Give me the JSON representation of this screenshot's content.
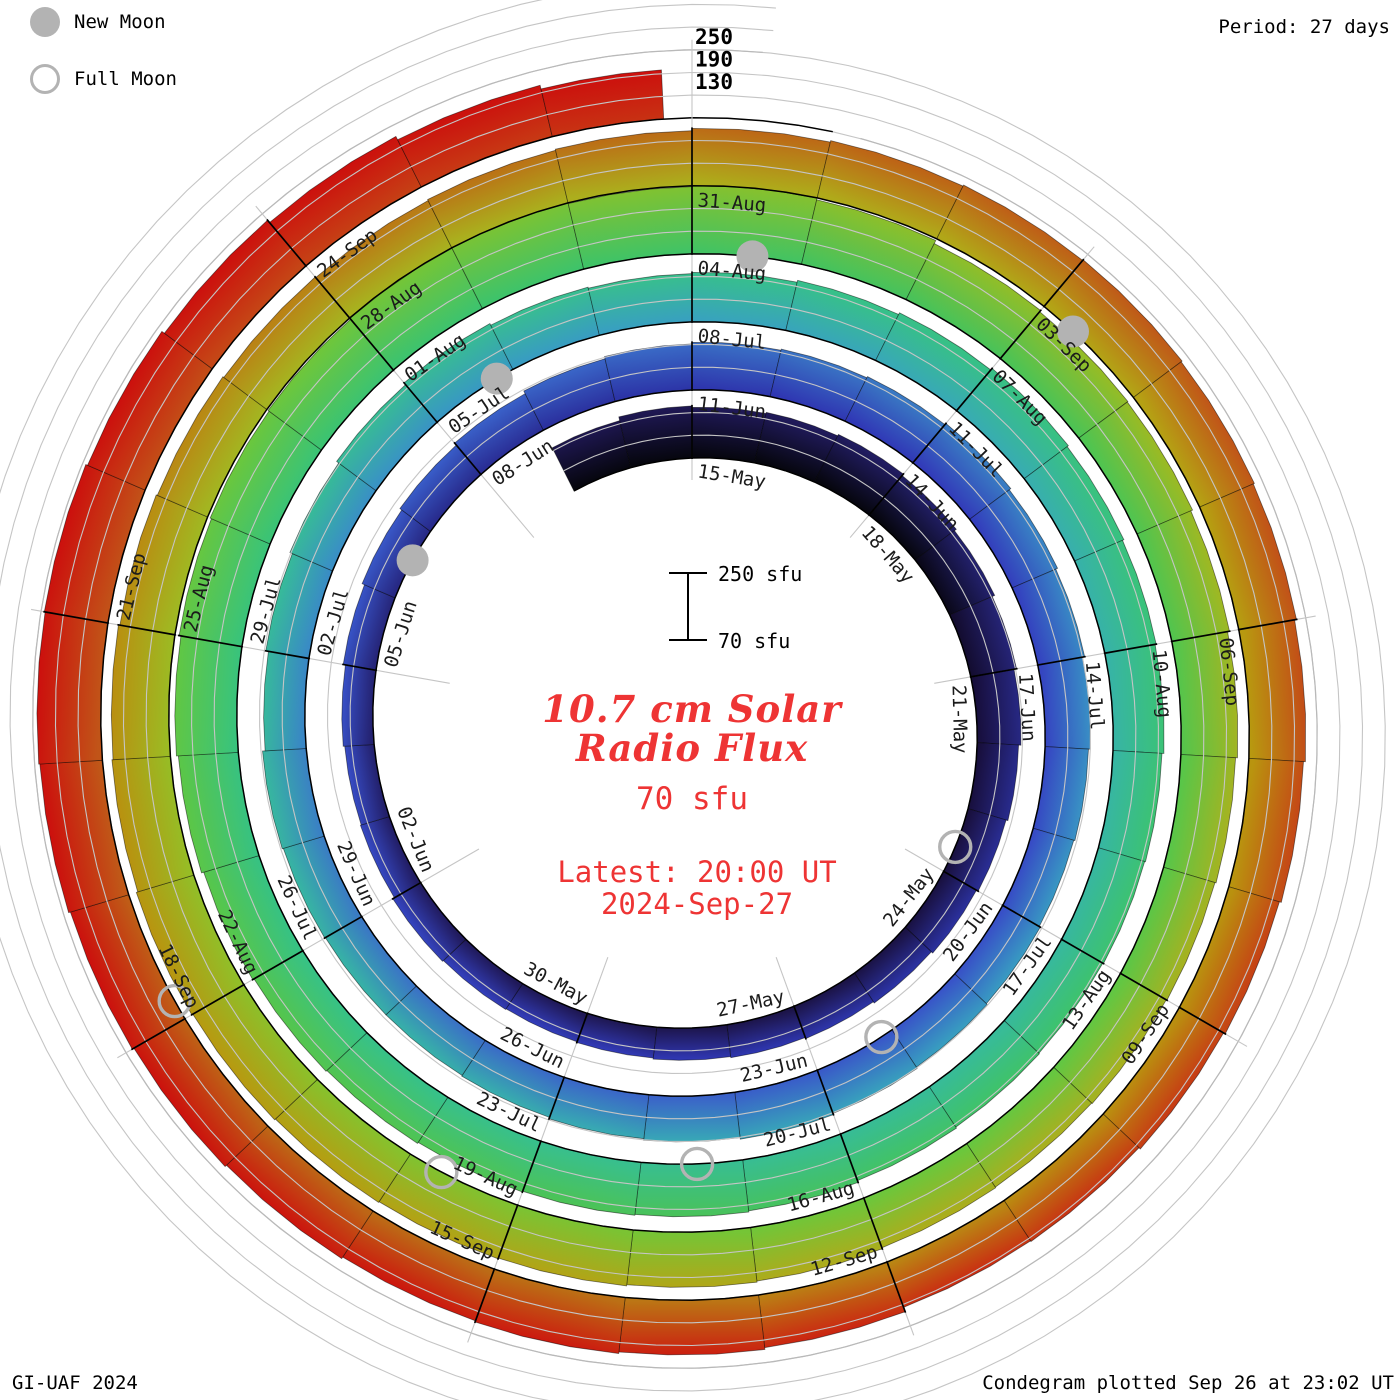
{
  "legend": {
    "new_moon_label": "New Moon",
    "full_moon_label": "Full Moon",
    "moon_color": "#b3b3b3"
  },
  "header": {
    "period_label": "Period: 27 days"
  },
  "footer": {
    "credit": "GI-UAF 2024",
    "plotted_label": "Condegram plotted Sep 26 at 23:02 UT"
  },
  "center": {
    "scale_max_label": "250 sfu",
    "scale_min_label": "70 sfu",
    "title_line1": "10.7 cm Solar",
    "title_line2": "Radio Flux",
    "unit_label": "70 sfu",
    "latest_line1": "Latest: 20:00 UT",
    "latest_line2": "2024-Sep-27",
    "accent_color": "#ee3434"
  },
  "chart_data": {
    "type": "spiral_bar",
    "title": "10.7 cm Solar Radio Flux",
    "subtitle_unit": "70 sfu",
    "period_days": 27,
    "base_flux_sfu": 70,
    "flux_axis_ticks": [
      130,
      190,
      250
    ],
    "start_date": "2024-05-13",
    "top_of_circle_date": "2024-05-15",
    "end_date": "2024-09-26",
    "daily_flux_sfu": [
      198,
      208,
      204,
      207,
      211,
      206,
      200,
      193,
      186,
      180,
      175,
      170,
      165,
      161,
      158,
      155,
      152,
      150,
      152,
      155,
      150,
      148,
      152,
      158,
      165,
      171,
      178,
      186,
      192,
      196,
      199,
      202,
      206,
      201,
      196,
      190,
      185,
      182,
      185,
      188,
      192,
      195,
      191,
      187,
      183,
      181,
      181,
      183,
      186,
      179,
      186,
      193,
      200,
      206,
      201,
      198,
      201,
      206,
      211,
      216,
      212,
      208,
      205,
      200,
      198,
      196,
      198,
      201,
      206,
      209,
      211,
      213,
      216,
      219,
      223,
      229,
      234,
      239,
      243,
      246,
      249,
      252,
      248,
      250,
      245,
      236,
      232,
      230,
      225,
      220,
      215,
      212,
      210,
      208,
      210,
      213,
      216,
      219,
      221,
      223,
      226,
      229,
      225,
      222,
      218,
      215,
      212,
      210,
      213,
      216,
      222,
      226,
      229,
      231,
      228,
      225,
      220,
      215,
      210,
      205,
      200,
      198,
      210,
      215,
      219,
      216,
      221,
      226,
      231,
      236,
      239,
      241,
      236,
      228,
      220,
      210,
      200
    ],
    "date_labels": [
      "15-May",
      "18-May",
      "21-May",
      "24-May",
      "27-May",
      "30-May",
      "02-Jun",
      "05-Jun",
      "08-Jun",
      "11-Jun",
      "14-Jun",
      "17-Jun",
      "20-Jun",
      "23-Jun",
      "26-Jun",
      "29-Jun",
      "02-Jul",
      "05-Jul",
      "08-Jul",
      "11-Jul",
      "14-Jul",
      "17-Jul",
      "20-Jul",
      "23-Jul",
      "26-Jul",
      "29-Jul",
      "01-Aug",
      "04-Aug",
      "07-Aug",
      "10-Aug",
      "13-Aug",
      "16-Aug",
      "19-Aug",
      "22-Aug",
      "25-Aug",
      "28-Aug",
      "31-Aug",
      "03-Sep",
      "06-Sep",
      "09-Sep",
      "12-Sep",
      "15-Sep",
      "18-Sep",
      "21-Sep",
      "24-Sep"
    ],
    "moons": {
      "new": [
        {
          "date": "2024-06-06",
          "day": 22.55
        },
        {
          "date": "2024-07-05",
          "day": 51.8
        },
        {
          "date": "2024-08-04",
          "day": 81.55
        },
        {
          "date": "2024-09-03",
          "day": 111.3
        }
      ],
      "full": [
        {
          "date": "2024-05-23",
          "day": 8.6
        },
        {
          "date": "2024-06-22",
          "day": 38.15
        },
        {
          "date": "2024-07-21",
          "day": 67.45
        },
        {
          "date": "2024-08-19",
          "day": 96.7
        },
        {
          "date": "2024-09-18",
          "day": 126.15
        }
      ]
    },
    "color_stops": [
      [
        -2,
        "#06060e"
      ],
      [
        0,
        "#170e3a"
      ],
      [
        6,
        "#1b1347"
      ],
      [
        11,
        "#201a5b"
      ],
      [
        15,
        "#252374"
      ],
      [
        18,
        "#292c92"
      ],
      [
        21,
        "#2d35ab"
      ],
      [
        24,
        "#3139b8"
      ],
      [
        27,
        "#3443c0"
      ],
      [
        31,
        "#3852c8"
      ],
      [
        35,
        "#3a63c9"
      ],
      [
        39,
        "#3a79c4"
      ],
      [
        43,
        "#398dc5"
      ],
      [
        47,
        "#389ec2"
      ],
      [
        51,
        "#38abb4"
      ],
      [
        54,
        "#37b3a6"
      ],
      [
        58,
        "#37ba9a"
      ],
      [
        62,
        "#38bf8f"
      ],
      [
        66,
        "#37c285"
      ],
      [
        70,
        "#3ac377"
      ],
      [
        74,
        "#3fc368"
      ],
      [
        77,
        "#47c25b"
      ],
      [
        80,
        "#50c44f"
      ],
      [
        83,
        "#5ac648"
      ],
      [
        86,
        "#68c73e"
      ],
      [
        89,
        "#78c434"
      ],
      [
        92,
        "#8ac02b"
      ],
      [
        95,
        "#9abb24"
      ],
      [
        98,
        "#a5b420"
      ],
      [
        102,
        "#adad1c"
      ],
      [
        105,
        "#b2a617"
      ],
      [
        108,
        "#b79b10"
      ],
      [
        110,
        "#b9920e"
      ],
      [
        113,
        "#ba8a12"
      ],
      [
        116,
        "#bb7315"
      ],
      [
        119,
        "#bd6316"
      ],
      [
        122,
        "#c05618"
      ],
      [
        125,
        "#c44a17"
      ],
      [
        127,
        "#c63b14"
      ],
      [
        129,
        "#c92d12"
      ],
      [
        131,
        "#cb2010"
      ],
      [
        133,
        "#cc160e"
      ],
      [
        136,
        "#cc0f0d"
      ]
    ],
    "grid_color": "#c5c5c5",
    "baseline_color": "#000000"
  }
}
